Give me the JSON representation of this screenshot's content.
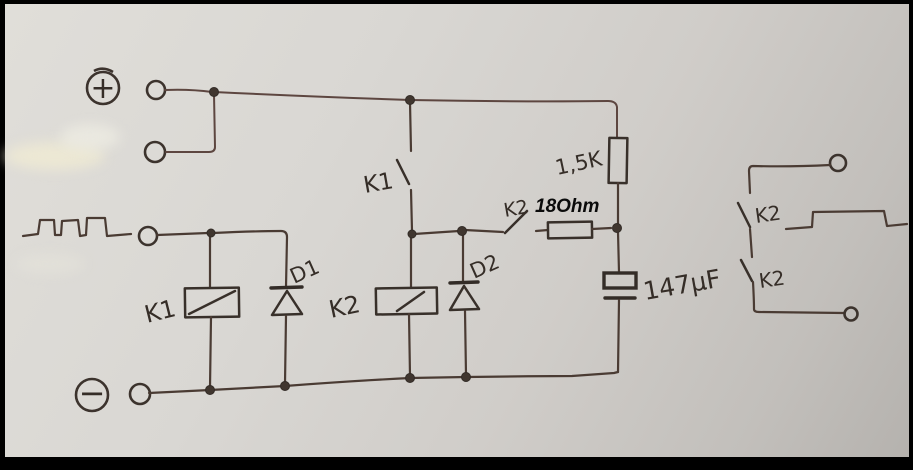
{
  "scene": {
    "description": "Photo of a hand-drawn relay flasher circuit schematic on grey paper with black frame",
    "colors": {
      "ink": "#38302a",
      "wire": "#4a3b33",
      "paper": "#d9d7d3",
      "frame": "#000000",
      "overlay_text": "#0b0b0b"
    }
  },
  "supply": {
    "positive": "+",
    "negative": "−"
  },
  "components": {
    "k1_switch": {
      "label": "K1",
      "type": "relay contact, open"
    },
    "k1_coil": {
      "label": "K1",
      "type": "relay coil"
    },
    "k2_coil": {
      "label": "K2",
      "type": "relay coil"
    },
    "k2_switch": {
      "label": "K2",
      "type": "relay contact, open"
    },
    "diode_1": {
      "label": "D1",
      "type": "flyback diode across K1 coil"
    },
    "diode_2": {
      "label": "D2",
      "type": "flyback diode across K2 coil"
    },
    "resistor_series": {
      "label": "1,5K",
      "type": "resistor"
    },
    "resistor_annotated": {
      "label": "18Ohm",
      "type": "resistor, value digitally annotated"
    },
    "capacitor": {
      "label": "147µF",
      "type": "electrolytic capacitor"
    },
    "out_contact_top": {
      "label": "K2",
      "type": "output relay contact"
    },
    "out_contact_bottom": {
      "label": "K2",
      "type": "output relay contact"
    }
  },
  "waveforms": {
    "input": "square pulse train at signal input terminal",
    "output": "single wide pulse at output contacts"
  }
}
